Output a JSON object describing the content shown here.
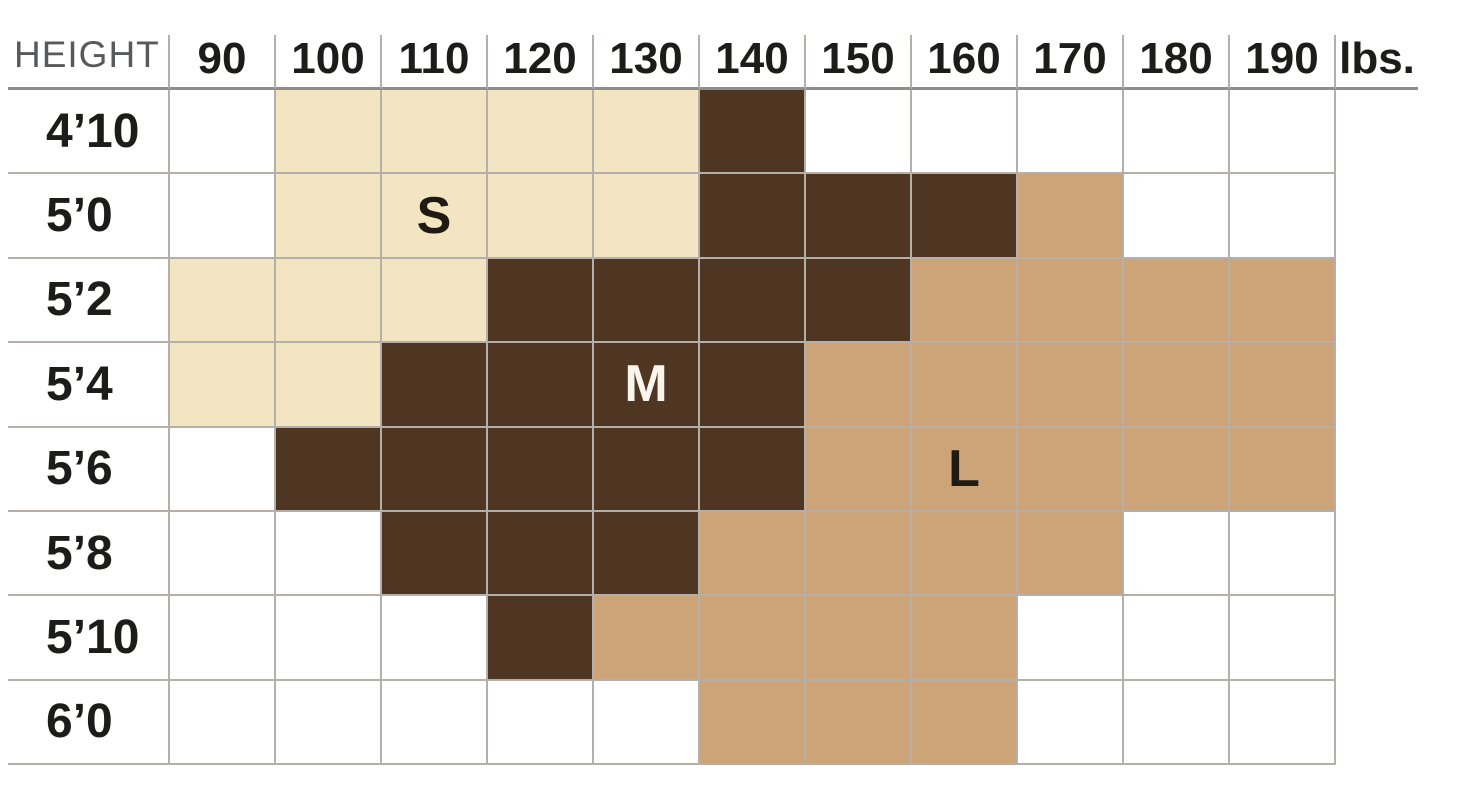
{
  "chart_data": {
    "type": "heatmap",
    "x_axis": {
      "unit_label": "lbs.",
      "categories": [
        "90",
        "100",
        "110",
        "120",
        "130",
        "140",
        "150",
        "160",
        "170",
        "180",
        "190"
      ]
    },
    "y_axis": {
      "label": "HEIGHT",
      "categories": [
        "4’10",
        "5’0",
        "5’2",
        "5’4",
        "5’6",
        "5’8",
        "5’10",
        "6’0"
      ]
    },
    "sizes": [
      "S",
      "M",
      "L"
    ],
    "cell_sizes": [
      [
        "",
        "S",
        "S",
        "S",
        "S",
        "M",
        "",
        "",
        "",
        "",
        ""
      ],
      [
        "",
        "S",
        "S",
        "S",
        "S",
        "M",
        "M",
        "M",
        "L",
        "",
        ""
      ],
      [
        "S",
        "S",
        "S",
        "M",
        "M",
        "M",
        "M",
        "L",
        "L",
        "L",
        "L"
      ],
      [
        "S",
        "S",
        "M",
        "M",
        "M",
        "M",
        "L",
        "L",
        "L",
        "L",
        "L"
      ],
      [
        "",
        "M",
        "M",
        "M",
        "M",
        "M",
        "L",
        "L",
        "L",
        "L",
        "L"
      ],
      [
        "",
        "",
        "M",
        "M",
        "M",
        "L",
        "L",
        "L",
        "L",
        "",
        ""
      ],
      [
        "",
        "",
        "",
        "M",
        "L",
        "L",
        "L",
        "L",
        "",
        "",
        ""
      ],
      [
        "",
        "",
        "",
        "",
        "",
        "L",
        "L",
        "L",
        "",
        "",
        ""
      ]
    ],
    "size_letter_markers": [
      {
        "letter": "S",
        "row_index": 1,
        "col_index": 2,
        "style": "dark"
      },
      {
        "letter": "M",
        "row_index": 3,
        "col_index": 4,
        "style": "light"
      },
      {
        "letter": "L",
        "row_index": 4,
        "col_index": 7,
        "style": "dark"
      }
    ]
  },
  "colors": {
    "size_s_fill": "#F3E5C2",
    "size_m_fill": "#4E3622",
    "size_l_fill": "#CDA378",
    "empty_fill": "#FFFFFF",
    "grid_line": "#B4AFA9",
    "header_underline": "#8D8D8D",
    "header_text": "#1C1C1A",
    "row_label_text": "#1C1C1A",
    "height_label_text": "#58595B",
    "letter_dark_text": "#1F1A12",
    "letter_light_text": "#F9F5EC"
  }
}
